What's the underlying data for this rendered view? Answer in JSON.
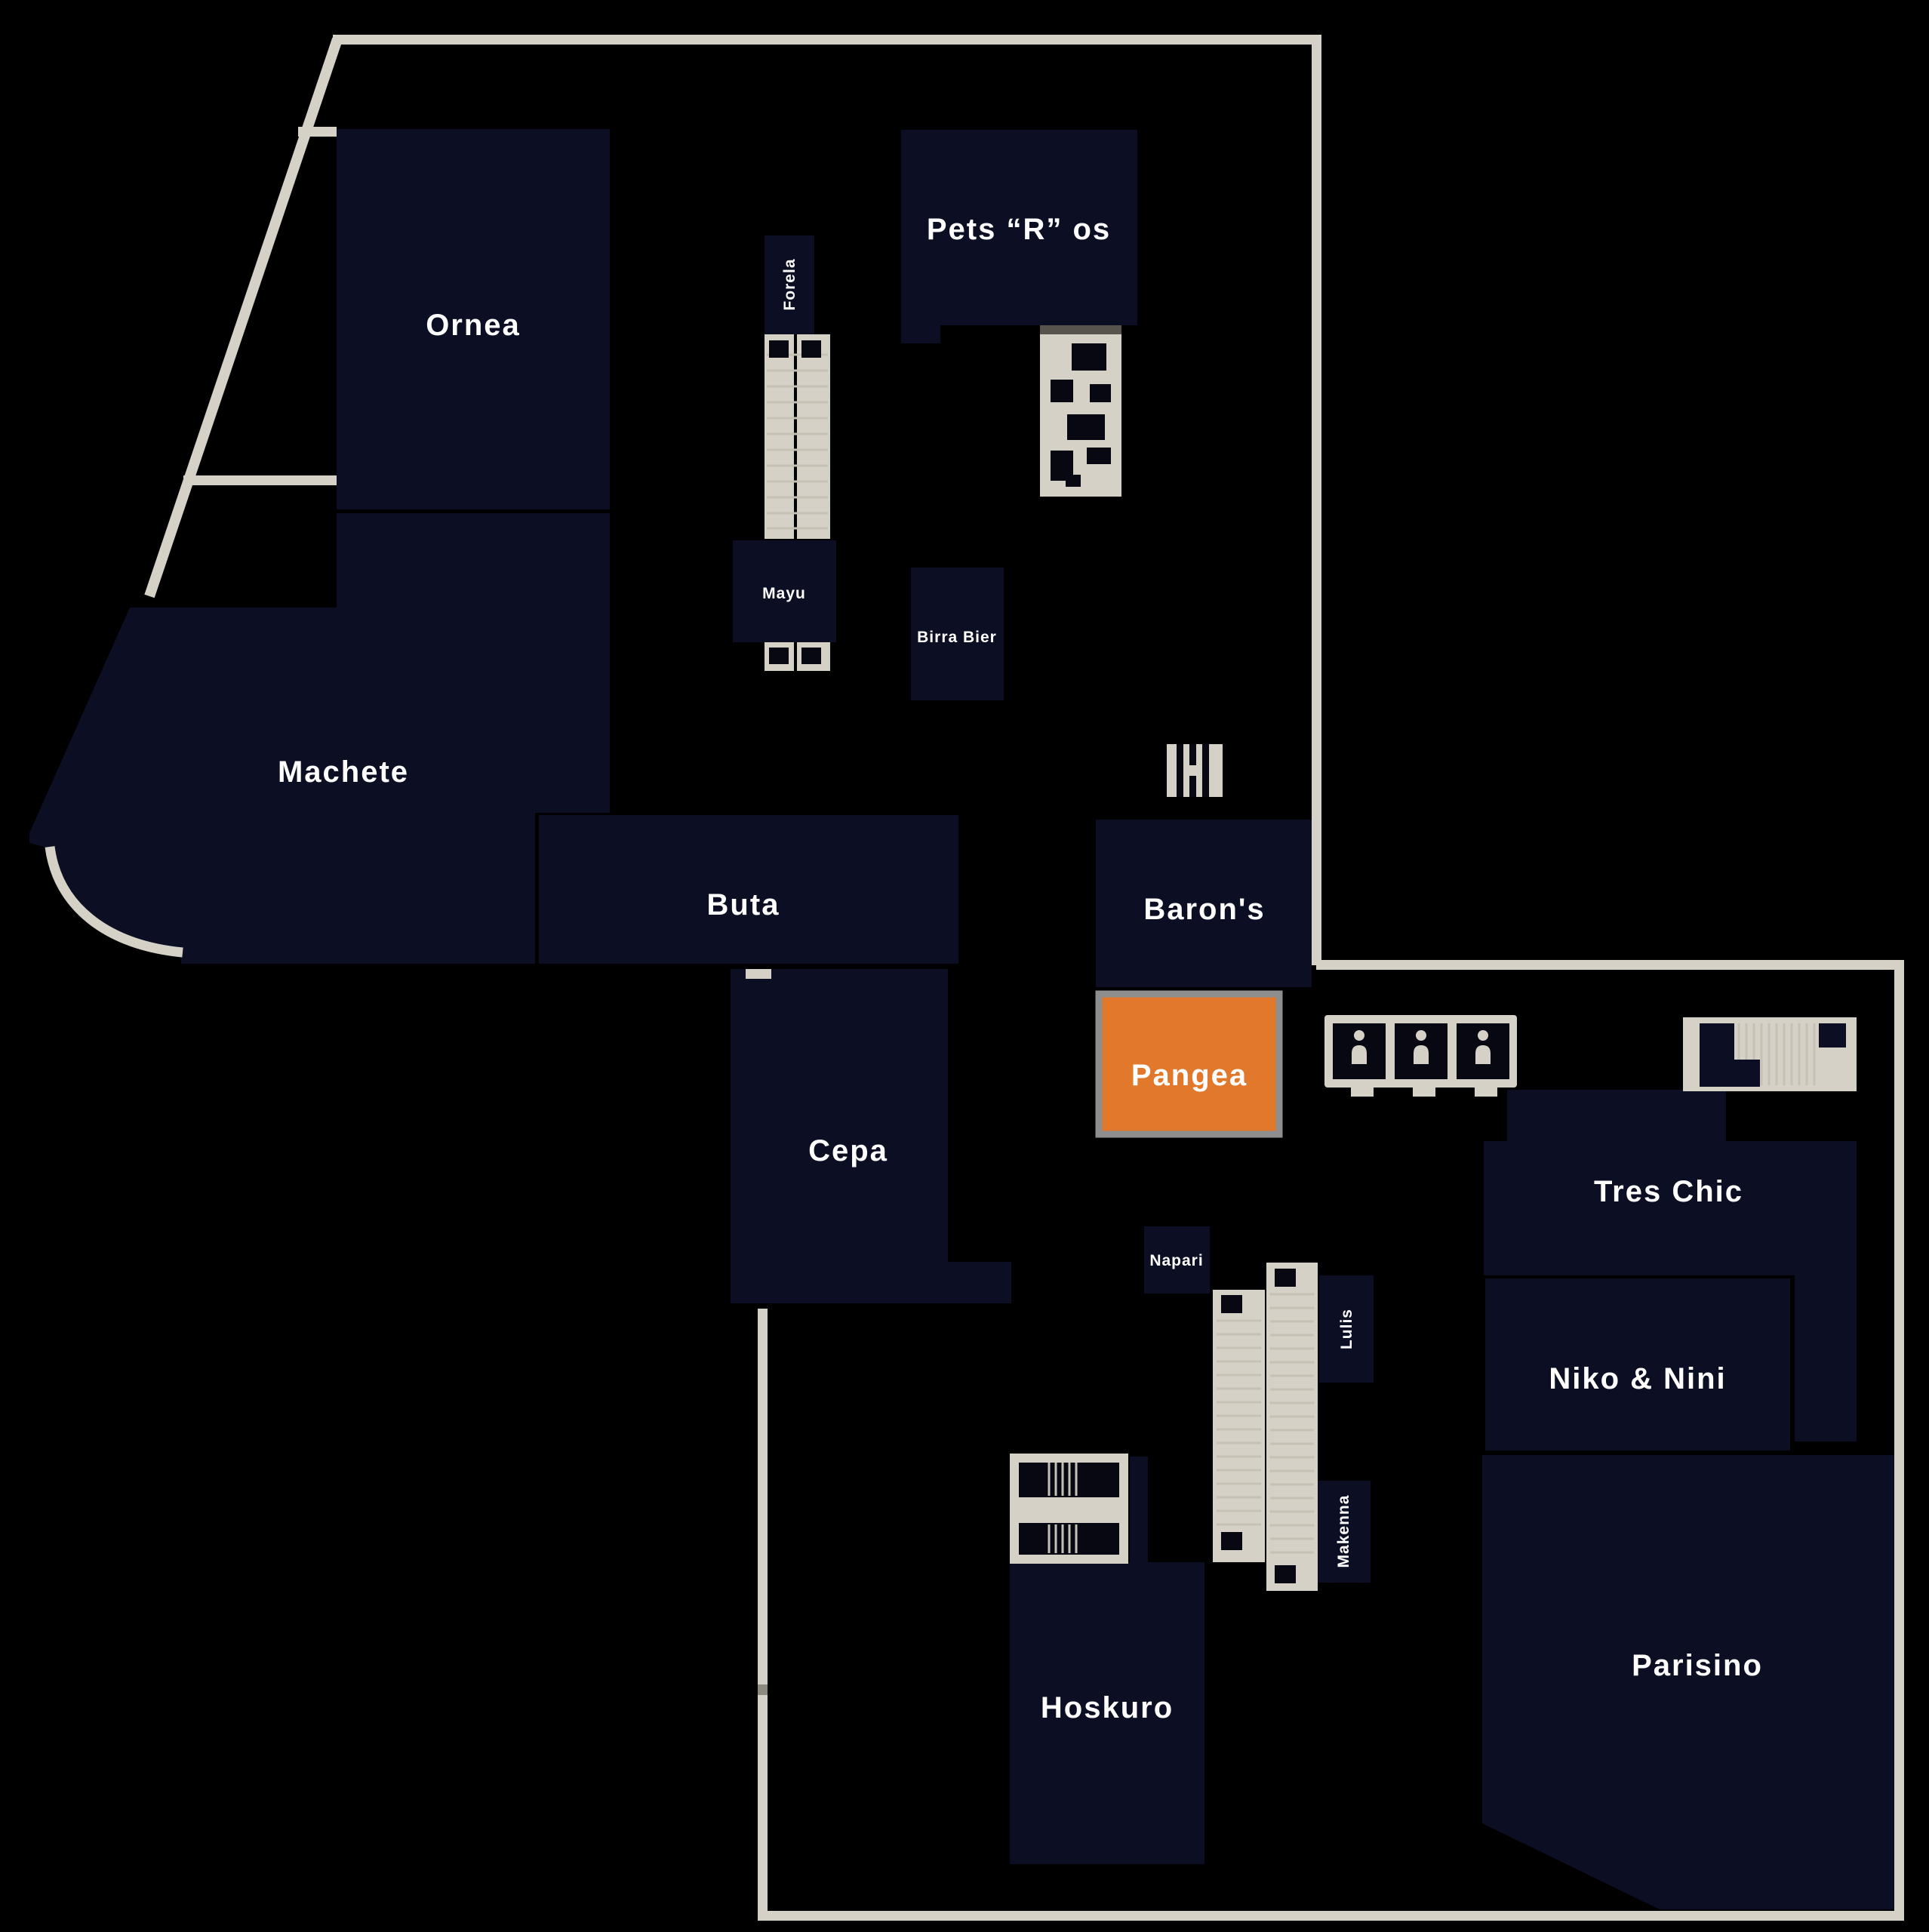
{
  "map": {
    "kind": "mall-floor-plan",
    "background": "#000000"
  },
  "colors": {
    "background": "#000000",
    "room_fill": "#0c0e23",
    "highlight_fill": "#e2782b",
    "highlight_border": "#8e8e8e",
    "wall": "#d6d1c7",
    "hatch": "#c6c1b5",
    "label_text": "#ffffff"
  },
  "rooms": {
    "ornea": {
      "name": "Ornea"
    },
    "machete": {
      "name": "Machete"
    },
    "buta": {
      "name": "Buta"
    },
    "cepa": {
      "name": "Cepa"
    },
    "forela": {
      "name": "Forela"
    },
    "mayu": {
      "name": "Mayu"
    },
    "pets_r_os": {
      "name": "Pets “R” os"
    },
    "birra_bier": {
      "name": "Birra Bier"
    },
    "barons": {
      "name": "Baron's"
    },
    "pangea": {
      "name": "Pangea",
      "highlighted": true
    },
    "napari": {
      "name": "Napari"
    },
    "lulis": {
      "name": "Lulis"
    },
    "makenna": {
      "name": "Makenna"
    },
    "hoskuro": {
      "name": "Hoskuro"
    },
    "tres_chic": {
      "name": "Tres Chic"
    },
    "niko_nini": {
      "name": "Niko & Nini"
    },
    "parisino": {
      "name": "Parisino"
    }
  },
  "icons": {
    "central_escalator": "escalator",
    "stairs_by_pets": "stairs",
    "stairs_by_barons": "stairs",
    "restrooms": "restrooms",
    "top_right_escalator": "escalator",
    "bottom_escalator": "escalator",
    "stairs_by_hoskuro": "stairs"
  }
}
